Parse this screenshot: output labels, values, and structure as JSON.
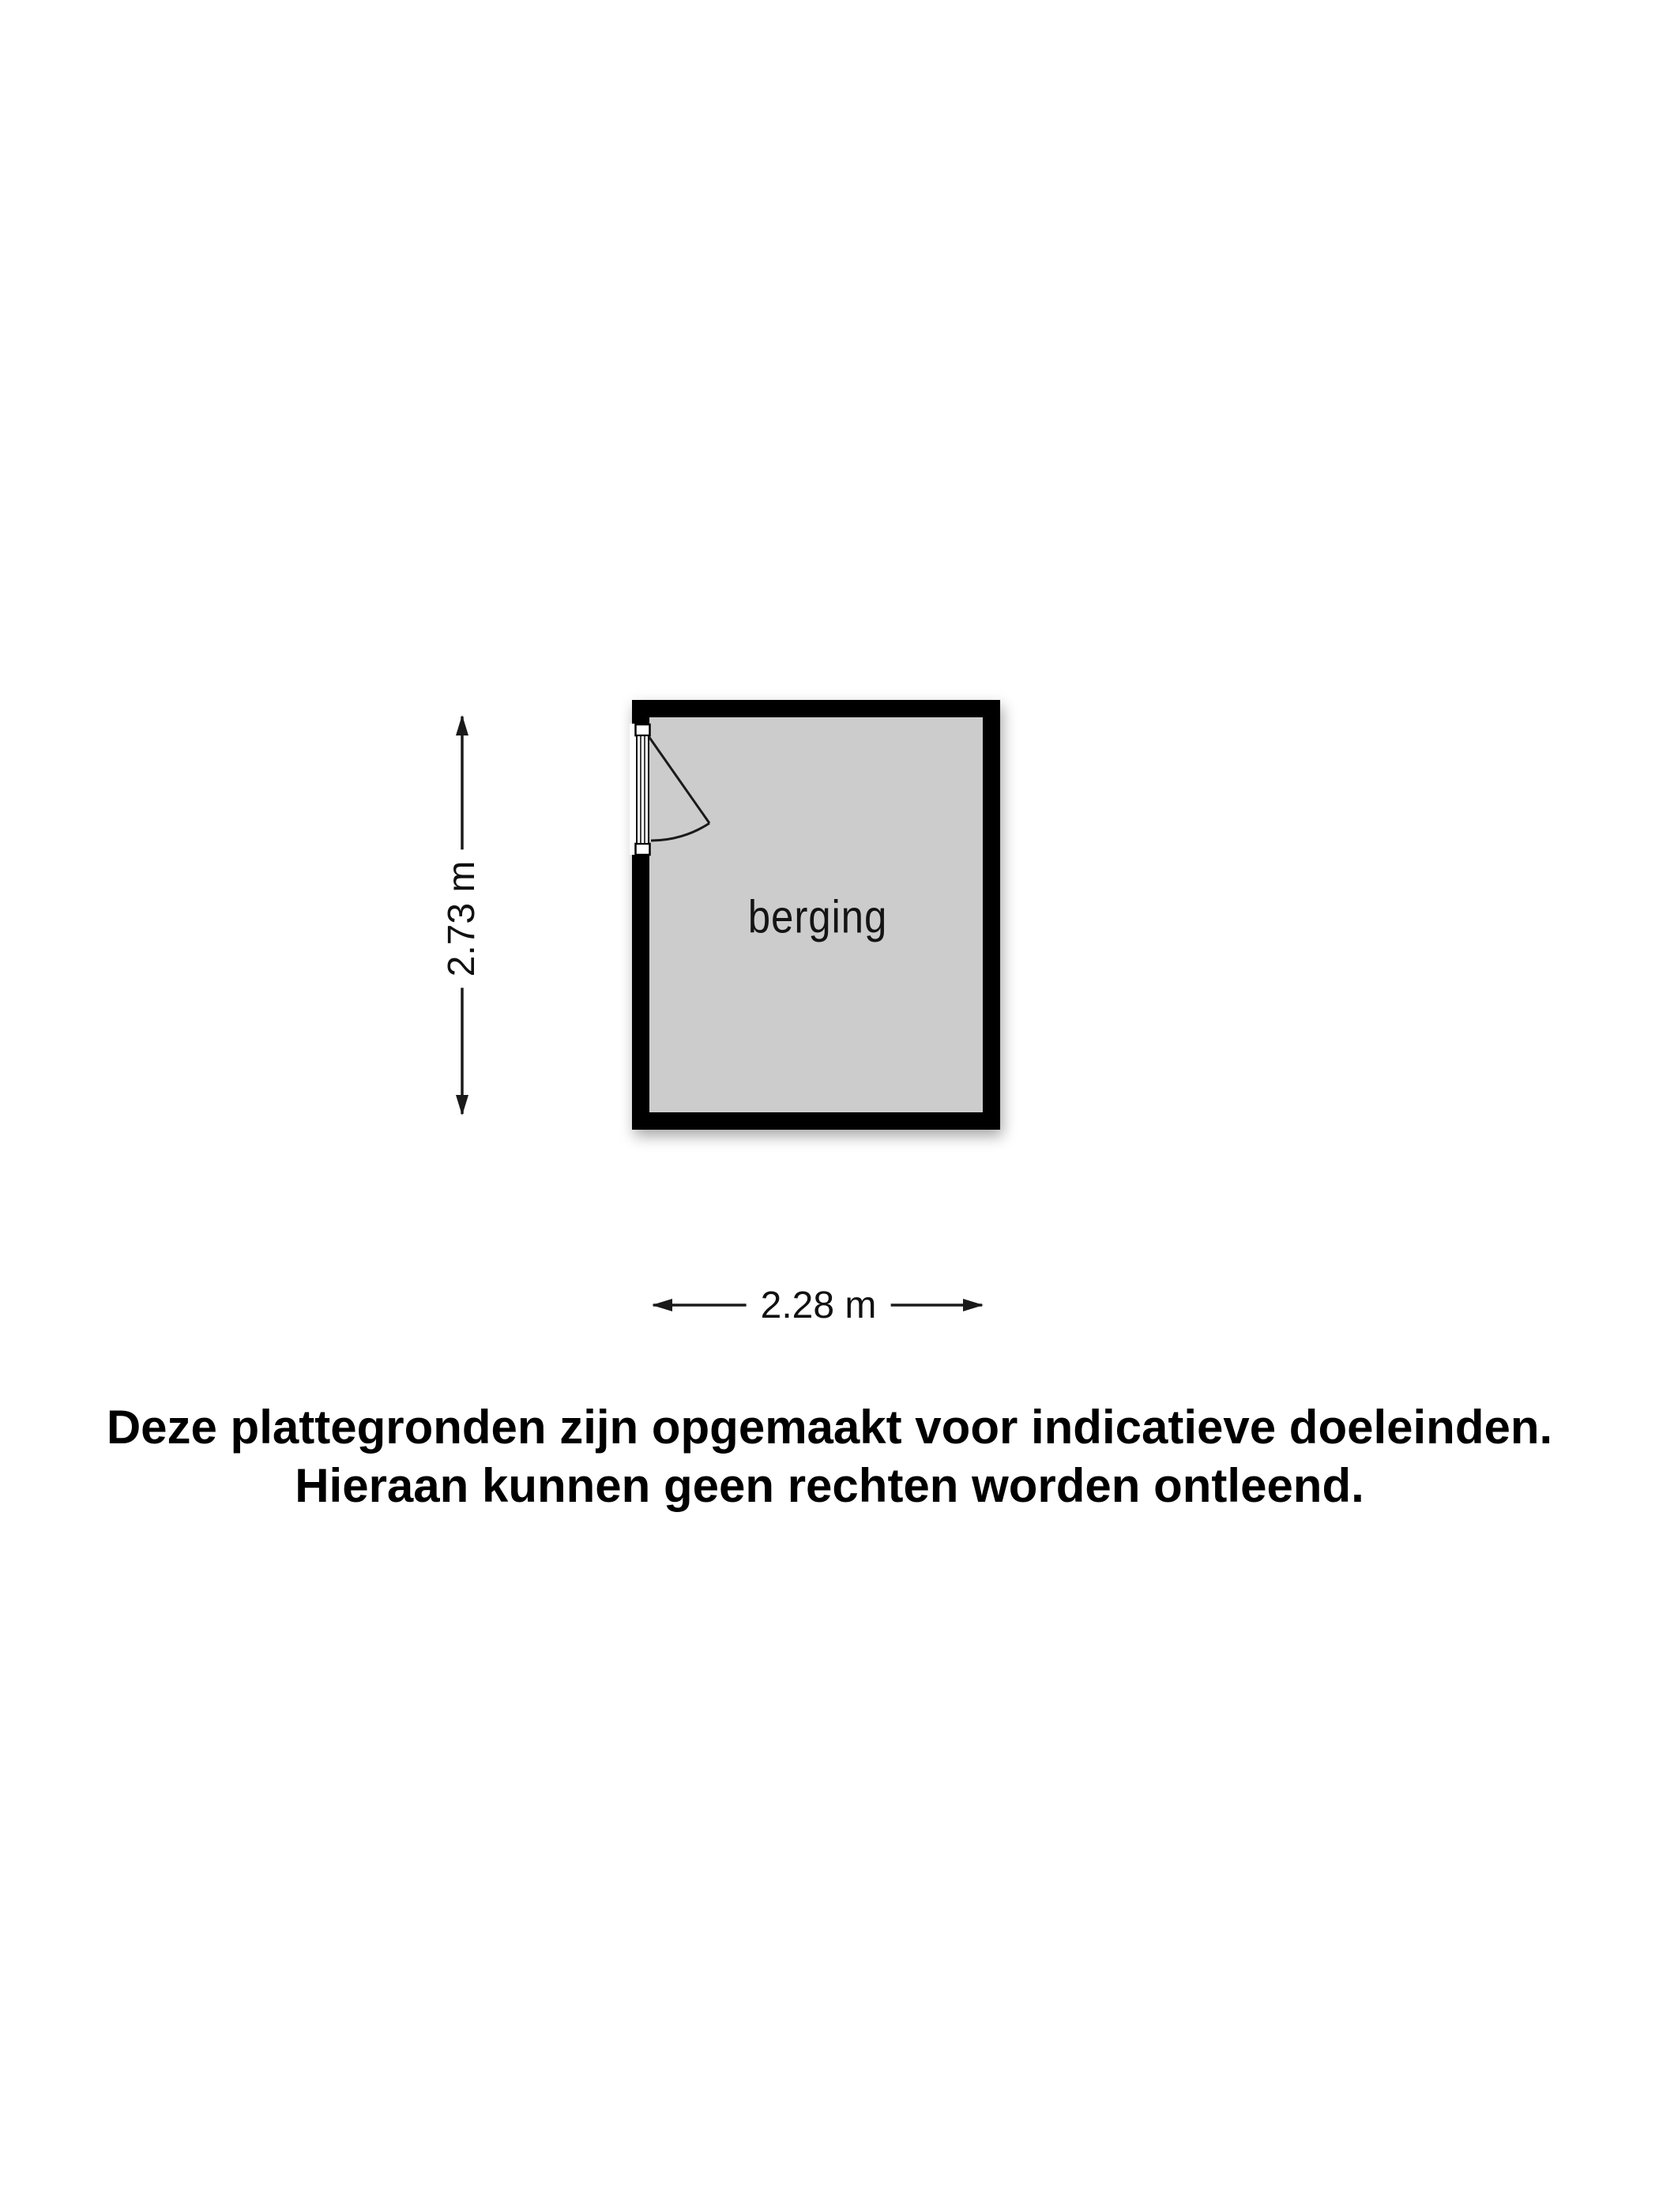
{
  "floor_plan": {
    "room_label": "berging",
    "dimensions": {
      "vertical": "2.73 m",
      "horizontal": "2.28 m"
    },
    "colors": {
      "background": "#ffffff",
      "wall": "#000000",
      "floor": "#cccccc",
      "dimension_lines": "#1a1a1a"
    }
  },
  "disclaimer": {
    "line1": "Deze plattegronden zijn opgemaakt voor indicatieve doeleinden.",
    "line2": "Hieraan kunnen geen rechten worden ontleend."
  }
}
